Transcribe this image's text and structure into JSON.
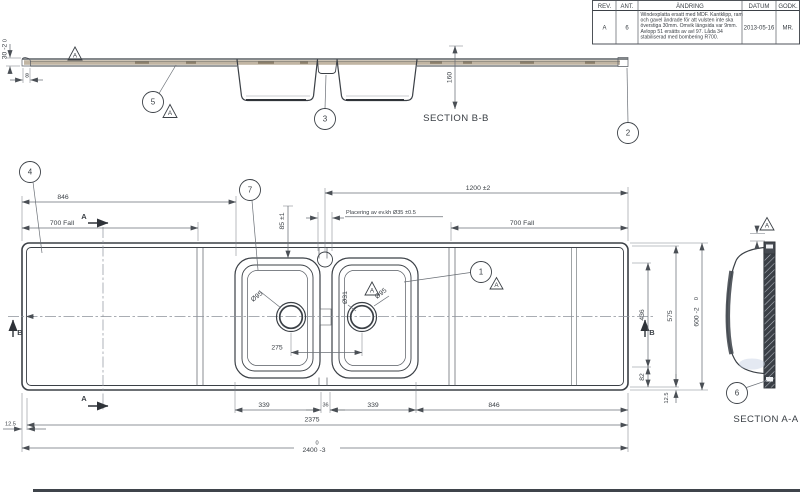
{
  "revision_table": {
    "headers": [
      "REV.",
      "ANT.",
      "ÄNDRING",
      "DATUM",
      "GODK."
    ],
    "row": {
      "rev": "A",
      "ant": "6",
      "andring_lines": [
        "Windexplatta ersatt med MDF. Kantklipp, ram",
        "och gavel ändrade för att vulsten inte ska",
        "överstiga 30mm. Omvik längsida var 9mm.",
        "Avlopp 51 ersätts av avl 97. Låda 34",
        "stabiliserad med bombering R700."
      ],
      "datum": "2013-05-16",
      "godk": "MR."
    }
  },
  "section_bb": {
    "label": "SECTION B-B",
    "balloon_5": "5",
    "balloon_3": "3",
    "balloon_2": "2",
    "datum_letter": "A",
    "dim_30_upper": "0",
    "dim_30_main": "30 -2",
    "dim_8": "8",
    "dim_160": "160"
  },
  "plan": {
    "balloon_4": "4",
    "balloon_7": "7",
    "balloon_1": "1",
    "datum_letter": "A",
    "arrow_a": "A",
    "arrow_b": "B",
    "dim_846_top": "846",
    "dim_700_fall_left": "700 Fall",
    "dim_1200": "1200 ±2",
    "dim_kh_note": "Placering av ev.kh  Ø35 ±0.5",
    "dim_85": "85 ±1",
    "dim_700_fall_right": "700 Fall",
    "dim_dia95_left": "Ø95",
    "dim_275": "275",
    "dim_dia31": "Ø31",
    "dim_dia95_right": "Ø95",
    "dim_436": "436",
    "dim_575": "575",
    "dim_600_upper": "0",
    "dim_600_main": "600 -2",
    "dim_82": "82",
    "dim_125_right": "12.5",
    "dim_339_left": "339",
    "dim_36": "36",
    "dim_339_right": "339",
    "dim_846_bottom": "846",
    "dim_2375": "2375",
    "dim_2400_upper": "0",
    "dim_2400_main": "2400 -3",
    "dim_125_left": "12.5"
  },
  "section_aa": {
    "label": "SECTION A-A",
    "balloon_6": "6",
    "datum_letter": "A"
  },
  "colors": {
    "line": "#3b4046",
    "dim_line": "#6a6f76",
    "bowl_left_rim": "#ccd6ef",
    "bowl_right_rim": "#c3b5a2",
    "profile_band": "#b2a28c"
  }
}
